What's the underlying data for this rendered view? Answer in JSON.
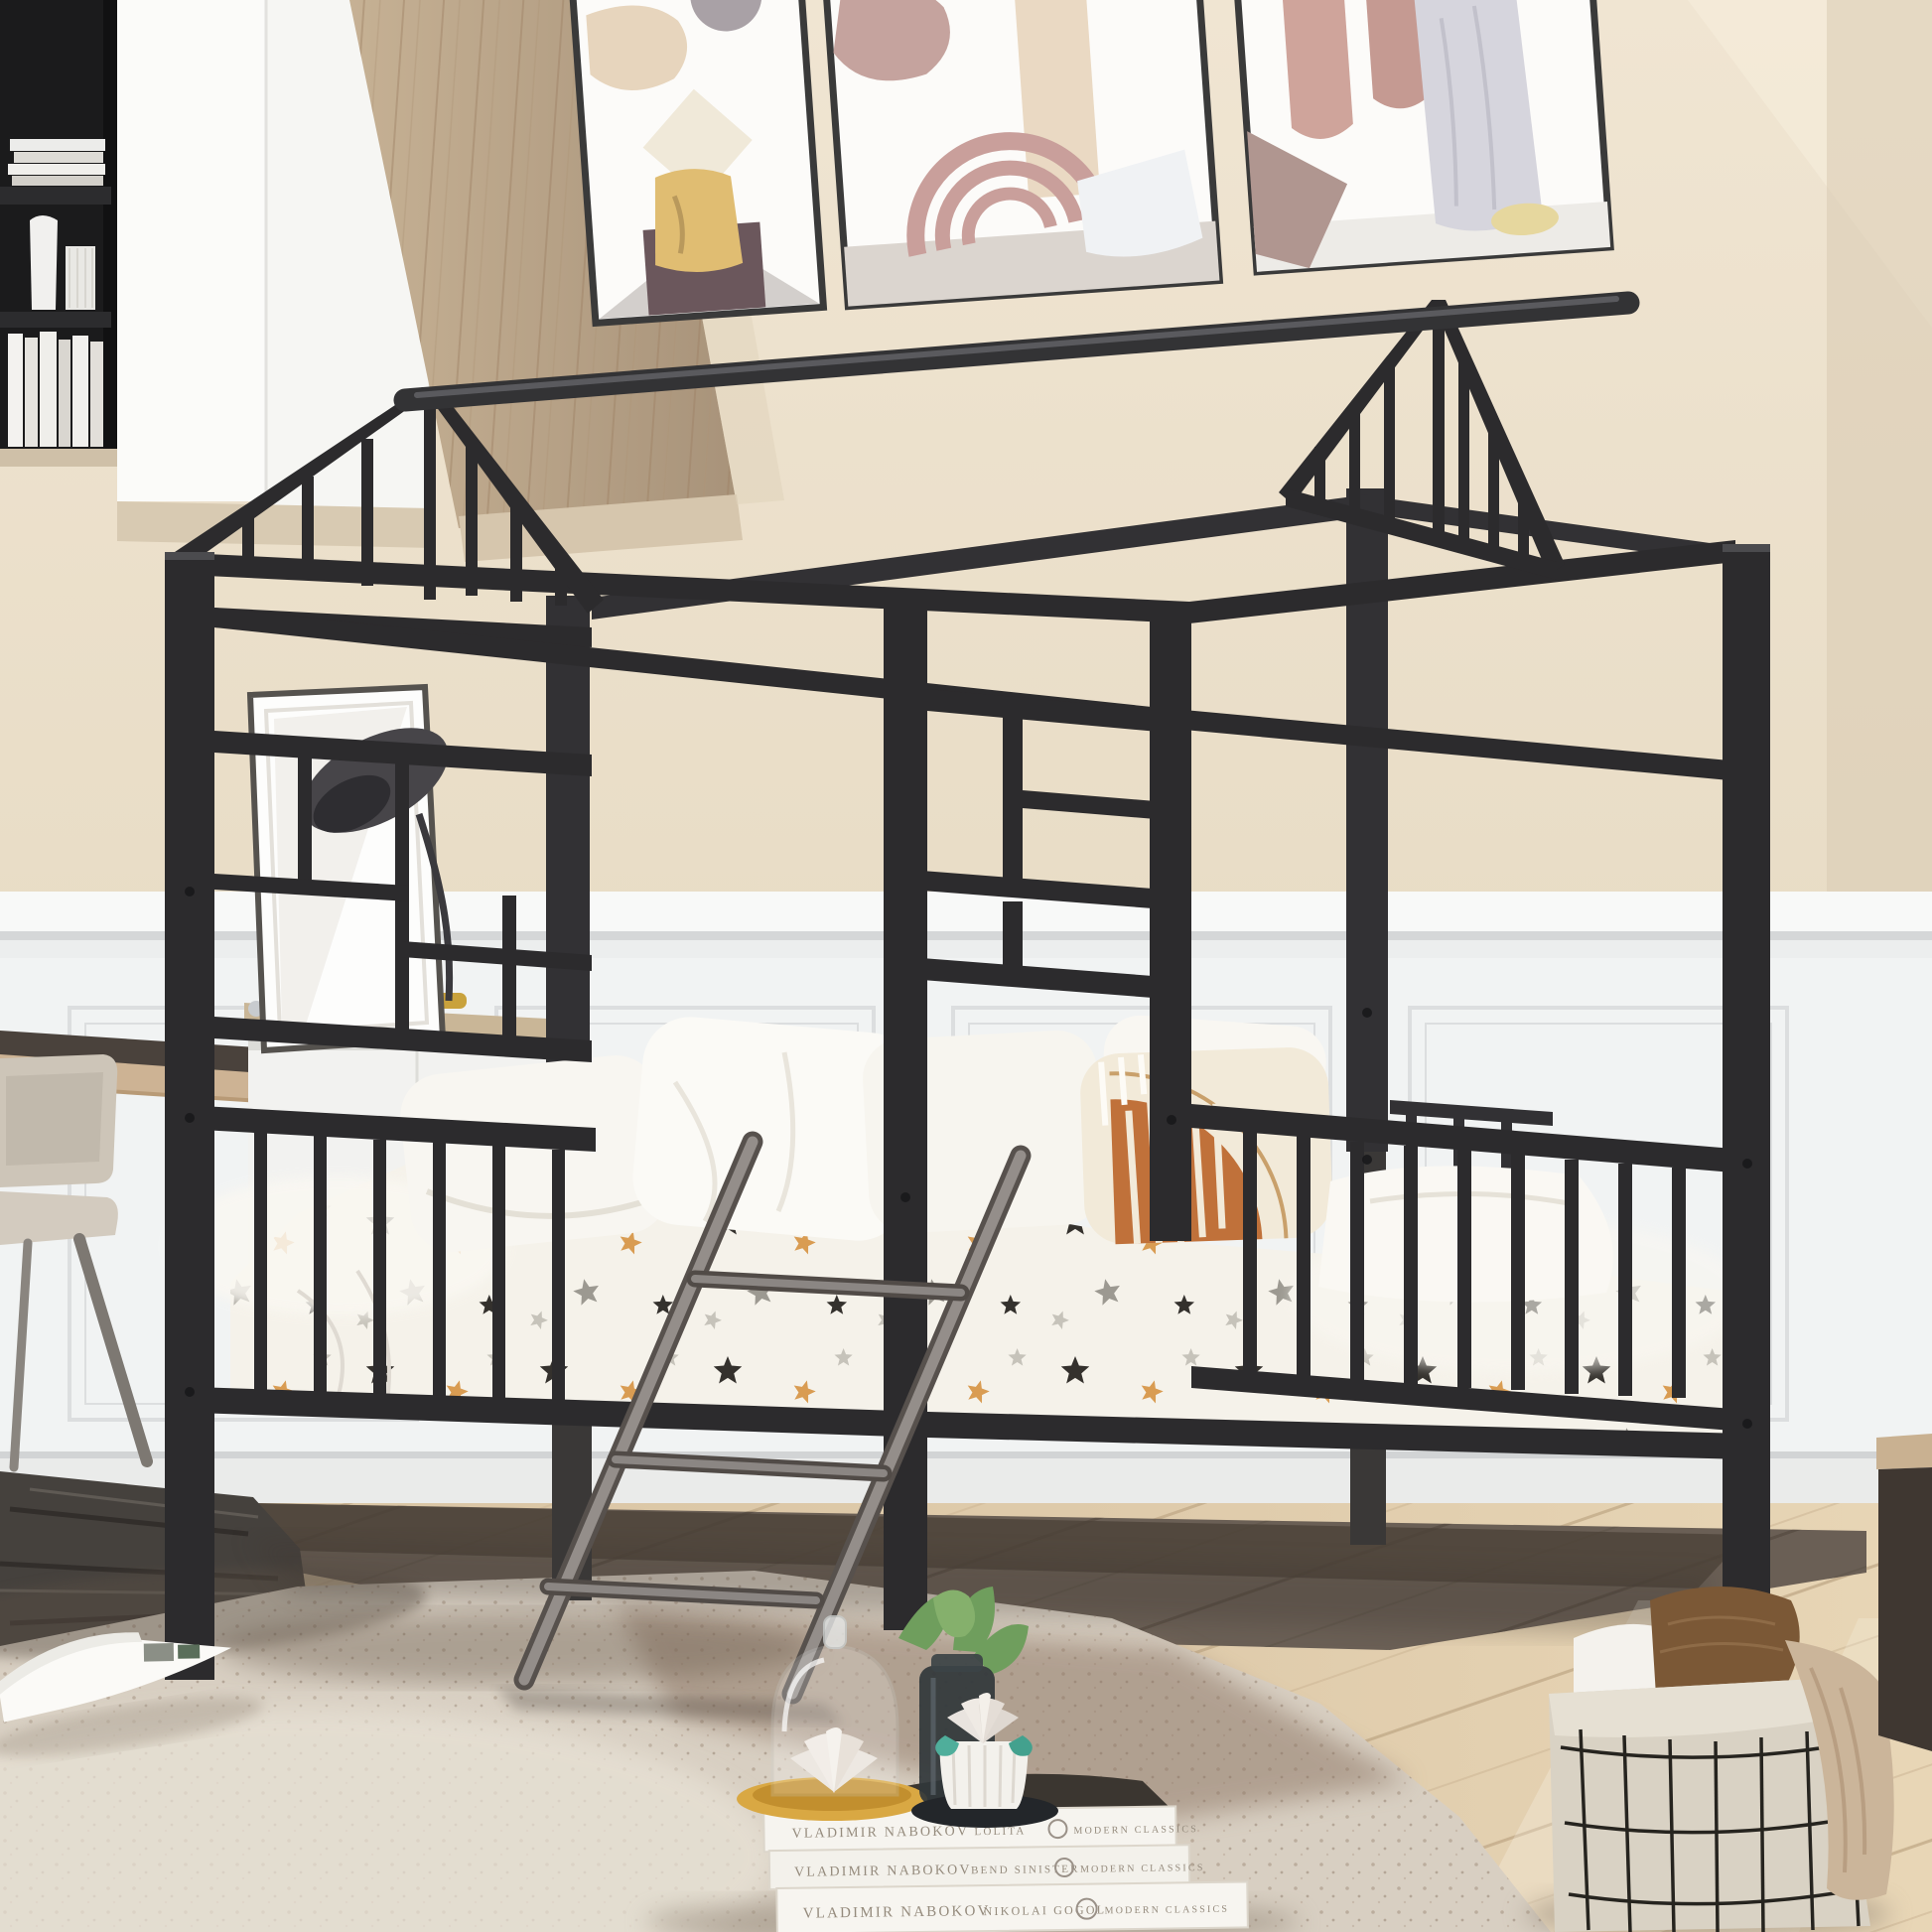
{
  "scene": {
    "kind": "product-photo",
    "subject": "black metal house-frame kids bed with ladder in styled bedroom"
  },
  "books": [
    {
      "author": "VLADIMIR NABOKOV",
      "title": "LOLITA",
      "publisher": "MODERN CLASSICS"
    },
    {
      "author": "VLADIMIR NABOKOV",
      "title": "BEND SINISTER",
      "publisher": "MODERN CLASSICS"
    },
    {
      "author": "VLADIMIR NABOKOV",
      "title": "NIKOLAI GOGOL",
      "publisher": "MODERN CLASSICS"
    }
  ],
  "palette": {
    "wall": "#ece0cb",
    "wainscot": "#f2f4f4",
    "bed_frame": "#2c2b2d",
    "floor_wood": "#dcc9aa",
    "dark_floor": "#6a5f55",
    "rug": "#d8cfc2",
    "rug_accent": "#8a7261",
    "dark_rug": "#45413d",
    "accent_pillow": "#c0713a",
    "bedding": "#f5f2ea",
    "ladder": "#8f8a87",
    "wood_panel": "#b7a286",
    "gold_tray": "#d9a843"
  },
  "objects": [
    "house-bed-frame",
    "ladder",
    "star-print-bedding",
    "accent-pillow",
    "gallery-frames",
    "bookshelf",
    "desk",
    "chair",
    "desk-lamp",
    "book-stack",
    "glass-cloche",
    "succulent-pot",
    "wire-basket",
    "area-rug"
  ]
}
